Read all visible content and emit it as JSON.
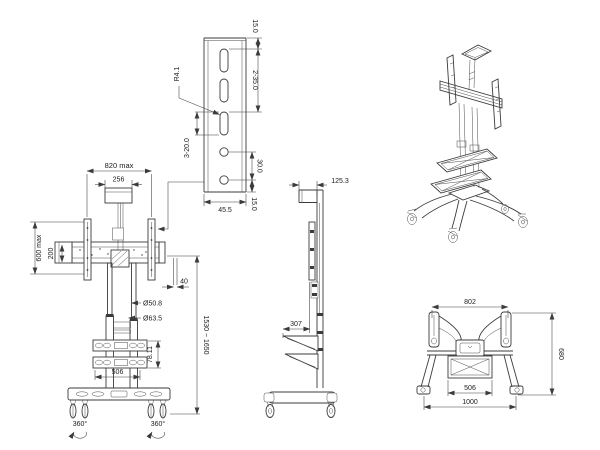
{
  "detail_view": {
    "edge_to_slot": "15.0",
    "slot_pitch": "2-35.0",
    "slot_radius": "R4.1",
    "slot_length": "3-20.0",
    "hole_pitch": "30.0",
    "plate_width": "45.5",
    "hole_to_edge": "15.0"
  },
  "front_view": {
    "max_width": "820 max",
    "top_plate_width": "256",
    "max_height": "600 max",
    "rail_height": "200",
    "end_offset": "40",
    "inner_tube_dia": "Ø50.8",
    "outer_tube_dia": "Ø63.5",
    "height_range": "1530 ~ 1650",
    "shelf_gap": "78.11",
    "shelf_width": "506",
    "caster_swivel_left": "360°",
    "caster_swivel_right": "360°"
  },
  "side_view": {
    "bracket_depth": "125.3",
    "shelf_depth": "307"
  },
  "top_view": {
    "bracket_width": "802",
    "base_depth": "680",
    "shelf_width": "506",
    "base_width": "1000"
  }
}
